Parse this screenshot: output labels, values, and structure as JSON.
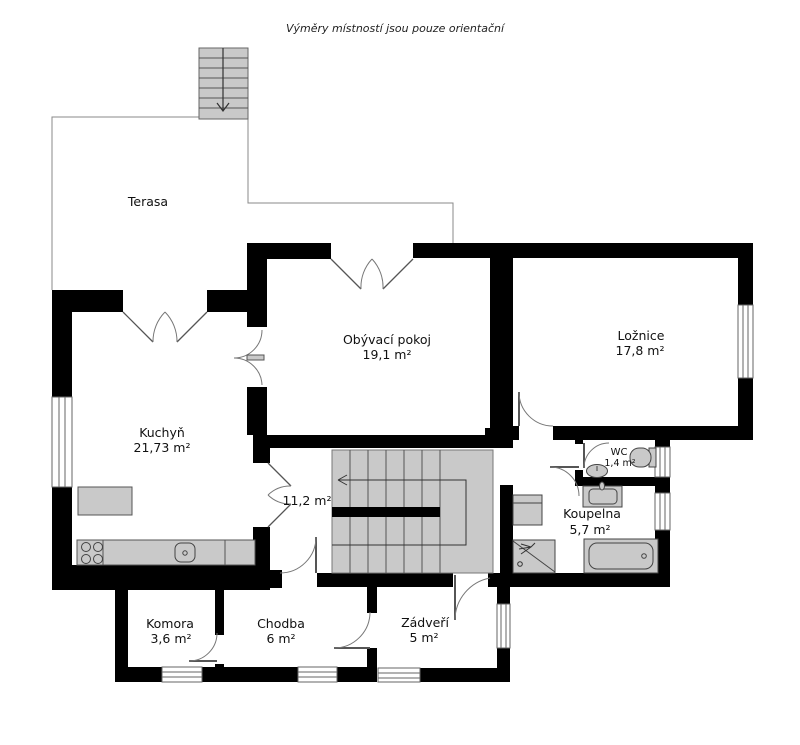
{
  "disclaimer": "Výměry místností jsou pouze orientační",
  "rooms": {
    "terasa": {
      "name": "Terasa"
    },
    "kuchyn": {
      "name": "Kuchyň",
      "area": "21,73 m²"
    },
    "obyvaci": {
      "name": "Obývací pokoj",
      "area": "19,1 m²"
    },
    "loznice": {
      "name": "Ložnice",
      "area": "17,8 m²"
    },
    "hala": {
      "area": "11,2 m²"
    },
    "wc": {
      "name": "WC",
      "area": "1,4 m²"
    },
    "koupelna": {
      "name": "Koupelna",
      "area": "5,7 m²"
    },
    "komora": {
      "name": "Komora",
      "area": "3,6 m²"
    },
    "chodba": {
      "name": "Chodba",
      "area": "6 m²"
    },
    "zadveri": {
      "name": "Zádveří",
      "area": "5 m²"
    }
  },
  "colors": {
    "wall": "#000000",
    "fixture_fill": "#c9c9c9",
    "stair_fill": "#c9c9c9",
    "thin_line": "#666666",
    "background": "#ffffff"
  }
}
